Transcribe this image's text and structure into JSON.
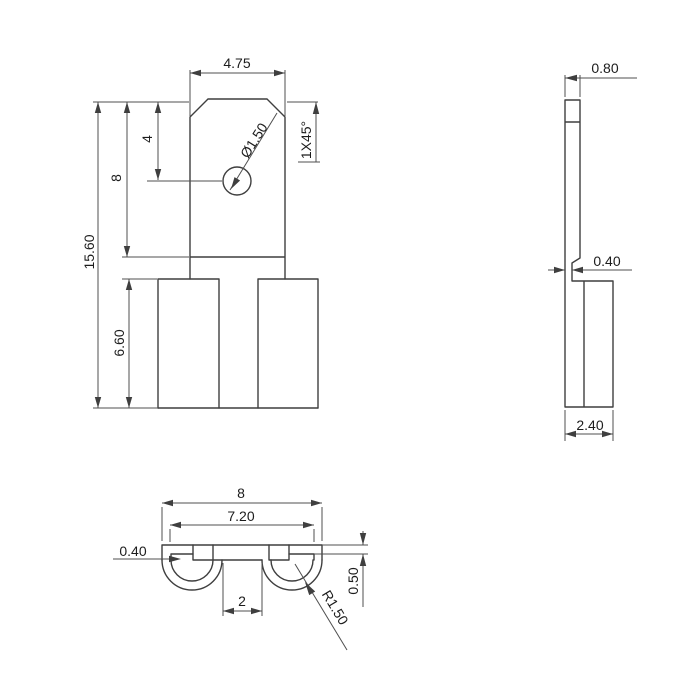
{
  "drawing": {
    "background": "#ffffff",
    "line_color": "#3f3f3f",
    "text_color": "#1c1c1c",
    "views": {
      "front": {
        "dims": {
          "tab_width": "4.75",
          "hole_diameter": "Ø1.50",
          "chamfer": "1X45°",
          "hole_offset": "4",
          "tab_length": "8",
          "overall_length": "15.60",
          "leg_length": "6.60"
        }
      },
      "side": {
        "dims": {
          "tab_thickness": "0.80",
          "material_thickness": "0.40",
          "body_depth": "2.40"
        }
      },
      "bottom": {
        "dims": {
          "overall_width": "8",
          "inner_width": "7.20",
          "wall_thickness": "0.40",
          "leg_gap": "2",
          "strip_thickness": "0.50",
          "bend_radius": "R1.50"
        }
      }
    }
  }
}
